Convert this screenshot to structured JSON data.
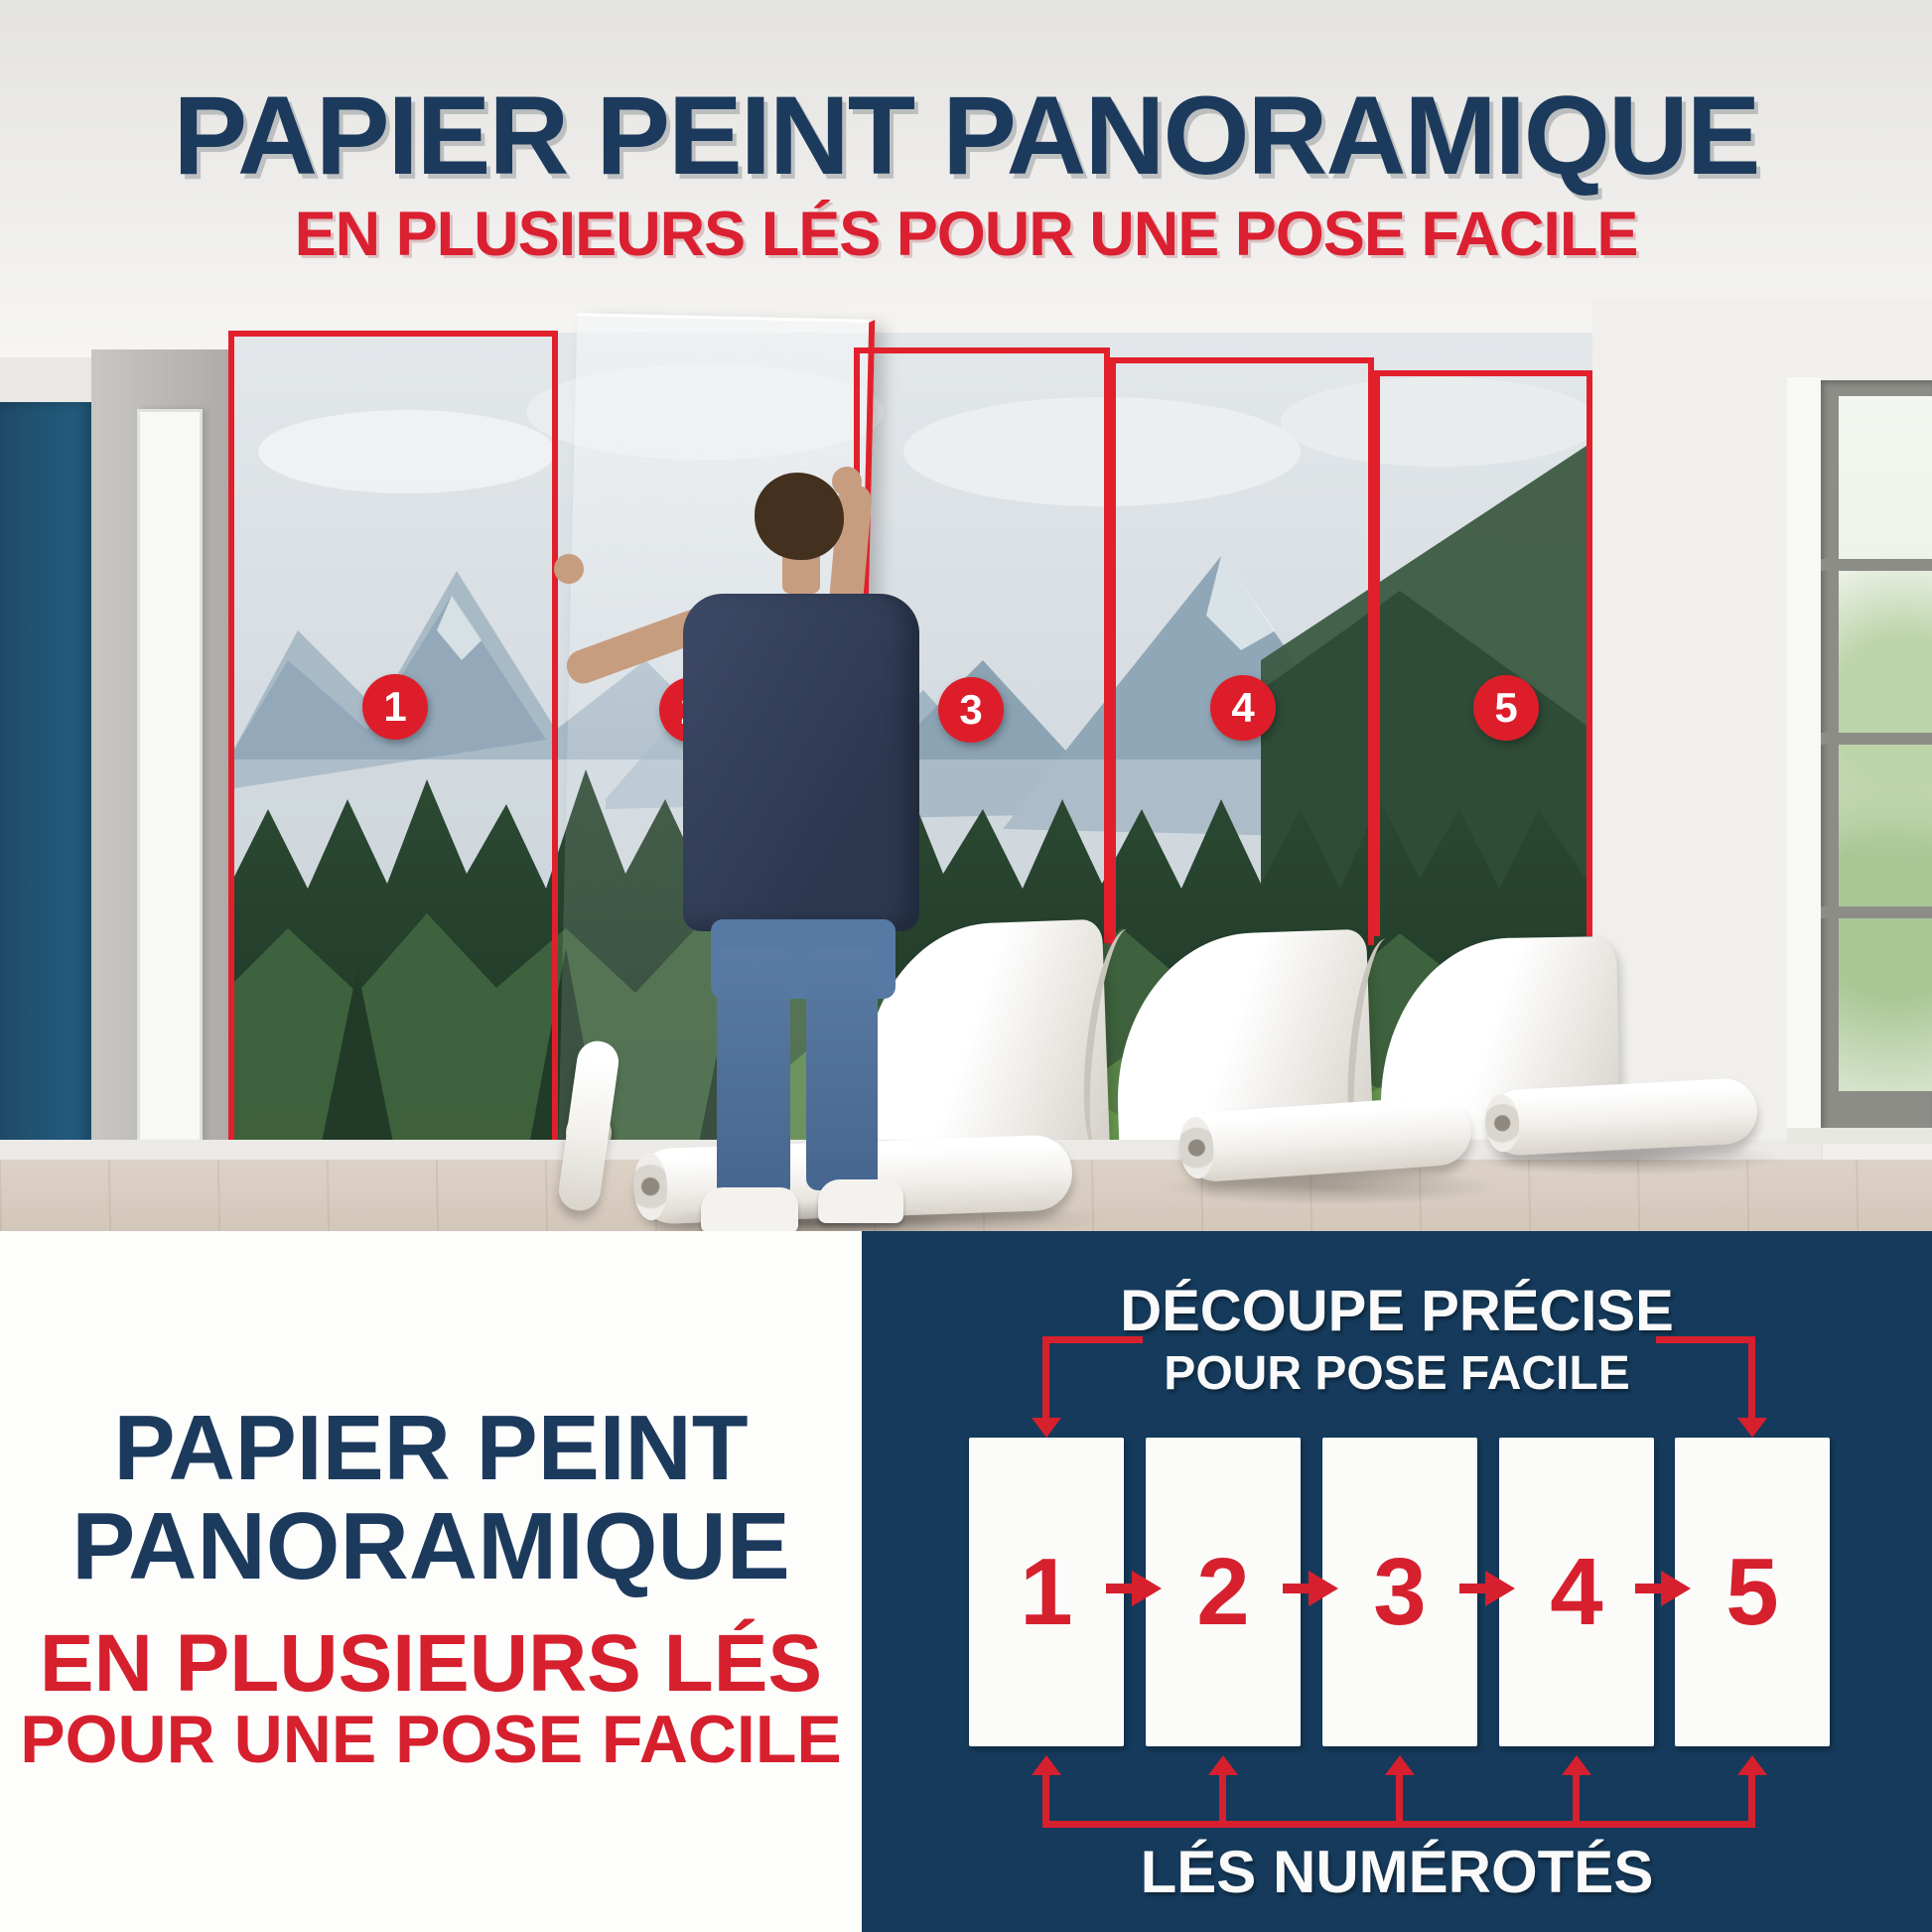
{
  "header": {
    "title": "PAPIER PEINT PANORAMIQUE",
    "subtitle": "EN PLUSIEURS LÉS POUR UNE POSE FACILE"
  },
  "photo": {
    "description": "man hanging panoramic mountain-forest wallpaper in numbered strips",
    "strip_labels": [
      "1",
      "2",
      "3",
      "4",
      "5"
    ]
  },
  "bottom_left": {
    "title_line1": "PAPIER PEINT",
    "title_line2": "PANORAMIQUE",
    "subtitle_line1": "EN PLUSIEURS LÉS",
    "subtitle_line2": "POUR UNE POSE FACILE"
  },
  "diagram": {
    "title_line1": "DÉCOUPE PRÉCISE",
    "title_line2": "POUR POSE FACILE",
    "panel_labels": [
      "1",
      "2",
      "3",
      "4",
      "5"
    ],
    "caption": "LÉS NUMÉROTÉS"
  },
  "colors": {
    "navy_panel": "#153a5b",
    "title_navy": "#1c3a5c",
    "accent_red": "#d6202e",
    "border_red": "#e2202c",
    "wall_navy": "#20506e",
    "floor_wood": "#d8cec3"
  }
}
